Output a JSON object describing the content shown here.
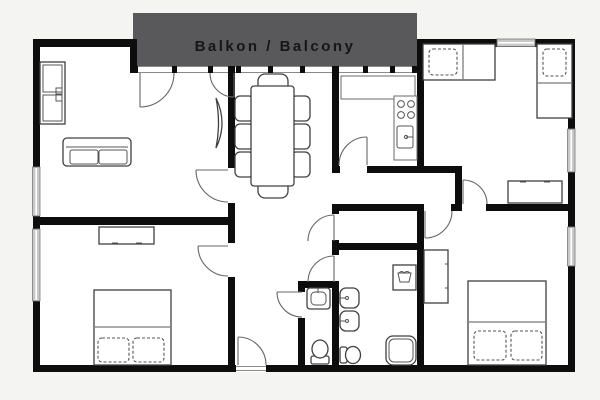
{
  "balcony": {
    "label": "Balkon / Balcony"
  },
  "colors": {
    "background": "#f4f4f2",
    "wall": "#0d0d0d",
    "balcony_fill": "#59595b",
    "balcony_text": "#161616",
    "room_fill": "#ffffff",
    "window_fill": "#c9c9c9",
    "furniture_line": "#404040",
    "door_line": "#666666"
  }
}
